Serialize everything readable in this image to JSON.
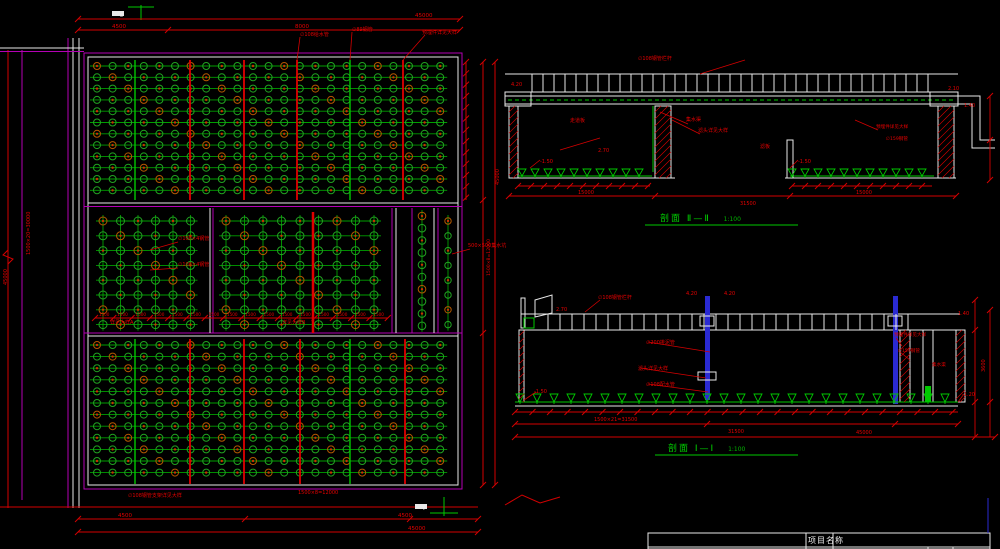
{
  "colors": {
    "background": "#000000",
    "cad_red": "#d40000",
    "cad_green": "#00c800",
    "nozzle_green": "#21a321",
    "nozzle_dot": "#c83200",
    "magenta": "#b400b4",
    "white": "#e9e9e9",
    "blue": "#2a2ad2"
  },
  "titles": {
    "section2": {
      "prefix": "剖面",
      "mark": "Ⅱ—Ⅱ",
      "scale": "1:100"
    },
    "section1": {
      "prefix": "剖面",
      "mark": "Ⅰ—Ⅰ",
      "scale": "1:100"
    },
    "title_block": {
      "project_label": "项目名称"
    },
    "marker_top": "Ⅱ",
    "marker_bottom": "Ⅰ"
  },
  "geometry": {
    "grids": [
      {
        "x": 97,
        "y": 66,
        "cols": 23,
        "rows": 12,
        "dx": 15.6,
        "dy": 11.3,
        "r": 3.5,
        "mesh": "h"
      },
      {
        "x": 97,
        "y": 345,
        "cols": 23,
        "rows": 12,
        "dx": 15.6,
        "dy": 11.6,
        "r": 3.5,
        "mesh": "h"
      },
      {
        "x": 103,
        "y": 221,
        "cols": 6,
        "rows": 8,
        "dx": 17.5,
        "dy": 14.8,
        "r": 4,
        "mesh": "hv"
      },
      {
        "x": 226,
        "y": 221,
        "cols": 9,
        "rows": 8,
        "dx": 18.5,
        "dy": 14.8,
        "r": 4,
        "mesh": "hv"
      },
      {
        "x": 422,
        "y": 216,
        "cols": 1,
        "rows": 10,
        "dx": 0,
        "dy": 12.2,
        "r": 3.8,
        "mesh": "v"
      },
      {
        "x": 448,
        "y": 221,
        "cols": 1,
        "rows": 8,
        "dx": 0,
        "dy": 14.8,
        "r": 3.2,
        "mesh": "v"
      }
    ],
    "feature_lines": [
      {
        "x": 135,
        "y1": 60,
        "y2": 200,
        "c": "#00c800",
        "w": 1.4
      },
      {
        "x": 190,
        "y1": 60,
        "y2": 200,
        "c": "#e00000",
        "w": 1.8
      },
      {
        "x": 244,
        "y1": 60,
        "y2": 200,
        "c": "#e00000",
        "w": 1.8
      },
      {
        "x": 297,
        "y1": 60,
        "y2": 200,
        "c": "#e00000",
        "w": 1.8
      },
      {
        "x": 350,
        "y1": 60,
        "y2": 200,
        "c": "#00c800",
        "w": 1.4
      },
      {
        "x": 403,
        "y1": 60,
        "y2": 200,
        "c": "#e00000",
        "w": 1.8
      },
      {
        "x": 135,
        "y1": 339,
        "y2": 484,
        "c": "#00c800",
        "w": 1.4
      },
      {
        "x": 190,
        "y1": 339,
        "y2": 484,
        "c": "#e00000",
        "w": 1.8
      },
      {
        "x": 244,
        "y1": 339,
        "y2": 484,
        "c": "#e00000",
        "w": 1.8
      },
      {
        "x": 300,
        "y1": 339,
        "y2": 484,
        "c": "#e00000",
        "w": 1.8
      },
      {
        "x": 350,
        "y1": 339,
        "y2": 484,
        "c": "#00c800",
        "w": 1.4
      },
      {
        "x": 405,
        "y1": 339,
        "y2": 484,
        "c": "#e00000",
        "w": 1.8
      },
      {
        "x": 313,
        "y1": 212,
        "y2": 333,
        "c": "#e00000",
        "w": 2.5
      }
    ],
    "ladders": [
      {
        "x1": 532,
        "x2": 935,
        "yt": 74,
        "yb": 92,
        "step": 11
      },
      {
        "x1": 548,
        "x2": 912,
        "yt": 314,
        "yb": 330,
        "step": 12
      }
    ],
    "triangle_rows": [
      {
        "x1": 522,
        "x2": 650,
        "y": 176,
        "step": 13,
        "h": 7
      },
      {
        "x1": 792,
        "x2": 932,
        "y": 176,
        "step": 13,
        "h": 7
      },
      {
        "x1": 520,
        "x2": 955,
        "y": 402,
        "step": 17,
        "h": 8
      }
    ],
    "tick_chains": [
      {
        "x1": 518,
        "x2": 650,
        "y": 186,
        "step": 13
      },
      {
        "x1": 792,
        "x2": 932,
        "y": 186,
        "step": 13
      },
      {
        "x1": 95,
        "x2": 388,
        "y": 318,
        "step": 18.3,
        "label": "1500"
      },
      {
        "x1": 515,
        "x2": 958,
        "y": 412,
        "step": 17.5
      },
      {
        "x1": 78,
        "x2": 460,
        "y": 19,
        "ticks": [
          78,
          460
        ]
      },
      {
        "x1": 78,
        "x2": 460,
        "y": 30,
        "ticks": [
          78,
          168,
          460
        ]
      },
      {
        "x1": 78,
        "x2": 478,
        "y": 519,
        "ticks": [
          78,
          245,
          410,
          478
        ]
      },
      {
        "x1": 78,
        "x2": 478,
        "y": 532,
        "ticks": [
          78,
          478
        ]
      },
      {
        "x1": 509,
        "x2": 956,
        "y": 196,
        "ticks": [
          509,
          655,
          790,
          956
        ]
      },
      {
        "x1": 515,
        "x2": 958,
        "y": 424,
        "ticks": [
          515,
          707,
          895,
          958
        ]
      },
      {
        "x1": 515,
        "x2": 995,
        "y": 437,
        "ticks": [
          515,
          995
        ]
      },
      {
        "x": 466,
        "y1": 62,
        "y2": 200,
        "step": 11.3,
        "vert": true
      },
      {
        "x": 483,
        "y1": 62,
        "y2": 485,
        "ticks": [
          62,
          200,
          333,
          485
        ],
        "vert": true
      },
      {
        "x": 495,
        "y1": 62,
        "y2": 485,
        "ticks": [
          62,
          485
        ],
        "vert": true
      },
      {
        "x": 990,
        "y1": 96,
        "y2": 180,
        "ticks": [
          96,
          140,
          180
        ],
        "vert": true
      },
      {
        "x": 975,
        "y1": 300,
        "y2": 437,
        "ticks": [
          300,
          330,
          402,
          437
        ],
        "vert": true
      },
      {
        "x": 990,
        "y1": 310,
        "y2": 437,
        "ticks": [
          310,
          402
        ],
        "vert": true
      }
    ],
    "hatches": [
      {
        "x": 509,
        "y": 106,
        "w": 9,
        "h": 72
      },
      {
        "x": 655,
        "y": 106,
        "w": 16,
        "h": 72
      },
      {
        "x": 938,
        "y": 106,
        "w": 16,
        "h": 72
      },
      {
        "x": 519,
        "y": 330,
        "w": 5,
        "h": 72
      },
      {
        "x": 900,
        "y": 330,
        "w": 10,
        "h": 72
      },
      {
        "x": 956,
        "y": 330,
        "w": 9,
        "h": 72
      }
    ],
    "leaders": [
      [
        560,
        150,
        600,
        138
      ],
      [
        688,
        124,
        660,
        112
      ],
      [
        700,
        134,
        672,
        120
      ],
      [
        745,
        60,
        700,
        74
      ],
      [
        540,
        160,
        530,
        168
      ],
      [
        798,
        160,
        790,
        168
      ],
      [
        878,
        130,
        855,
        120
      ],
      [
        600,
        300,
        585,
        312
      ],
      [
        648,
        342,
        710,
        352
      ],
      [
        640,
        368,
        706,
        378
      ],
      [
        648,
        384,
        708,
        392
      ],
      [
        896,
        338,
        902,
        346
      ],
      [
        900,
        352,
        910,
        360
      ],
      [
        536,
        392,
        524,
        400
      ],
      [
        964,
        394,
        958,
        402
      ],
      [
        470,
        249,
        452,
        254
      ],
      [
        178,
        242,
        150,
        250
      ],
      [
        178,
        268,
        150,
        270
      ],
      [
        300,
        37,
        297,
        60
      ],
      [
        352,
        32,
        350,
        60
      ],
      [
        425,
        35,
        403,
        60
      ]
    ]
  },
  "labels": [
    {
      "t": "45000",
      "x": 415,
      "y": 17
    },
    {
      "t": "4500",
      "x": 112,
      "y": 28
    },
    {
      "t": "8000",
      "x": 295,
      "y": 28
    },
    {
      "t": "∅108给水管",
      "x": 300,
      "y": 36,
      "s": 5
    },
    {
      "t": "∅89钢管",
      "x": 352,
      "y": 31,
      "s": 5
    },
    {
      "t": "预埋件详见大样",
      "x": 422,
      "y": 34,
      "s": 5
    },
    {
      "t": "1500×20=30000",
      "x": 30,
      "y": 255,
      "r": -90,
      "s": 5
    },
    {
      "t": "45000",
      "x": 7,
      "y": 285,
      "r": -90,
      "s": 5
    },
    {
      "t": "∅108×4钢管",
      "x": 178,
      "y": 240,
      "s": 5
    },
    {
      "t": "∅108×4钢管",
      "x": 178,
      "y": 266,
      "s": 5
    },
    {
      "t": "详见大样A",
      "x": 110,
      "y": 324,
      "s": 5
    },
    {
      "t": "详见大样B",
      "x": 282,
      "y": 324,
      "s": 5
    },
    {
      "t": "500×500集水坑",
      "x": 468,
      "y": 247,
      "s": 5
    },
    {
      "t": "1500×8=12000",
      "x": 490,
      "y": 276,
      "r": -90,
      "s": 4.6
    },
    {
      "t": "45000",
      "x": 499,
      "y": 185,
      "r": -90,
      "s": 5
    },
    {
      "t": "∅108钢管支架详见大样",
      "x": 128,
      "y": 497,
      "s": 5
    },
    {
      "t": "1500×8=12000",
      "x": 298,
      "y": 494,
      "s": 5
    },
    {
      "t": "4500",
      "x": 118,
      "y": 517
    },
    {
      "t": "4500",
      "x": 398,
      "y": 517
    },
    {
      "t": "45000",
      "x": 408,
      "y": 530
    },
    {
      "t": "∅108钢管栏杆",
      "x": 638,
      "y": 60,
      "s": 5
    },
    {
      "t": "2.70",
      "x": 598,
      "y": 152,
      "s": 5
    },
    {
      "t": "4.20",
      "x": 511,
      "y": 86,
      "s": 5
    },
    {
      "t": "走道板",
      "x": 570,
      "y": 122,
      "s": 5
    },
    {
      "t": "集水渠",
      "x": 686,
      "y": 121,
      "s": 5
    },
    {
      "t": "滤头详见大样",
      "x": 698,
      "y": 132,
      "s": 5
    },
    {
      "t": "滤板",
      "x": 760,
      "y": 148,
      "s": 5
    },
    {
      "t": "-1.50",
      "x": 540,
      "y": 163,
      "s": 5
    },
    {
      "t": "-1.50",
      "x": 798,
      "y": 163,
      "s": 5
    },
    {
      "t": "2.10",
      "x": 948,
      "y": 90,
      "s": 5
    },
    {
      "t": "1.40",
      "x": 964,
      "y": 107,
      "s": 5
    },
    {
      "t": "预埋件详见大样",
      "x": 876,
      "y": 128,
      "s": 4.6
    },
    {
      "t": "∅159钢管",
      "x": 886,
      "y": 140,
      "s": 4.6
    },
    {
      "t": "15000",
      "x": 578,
      "y": 194,
      "s": 5
    },
    {
      "t": "15000",
      "x": 856,
      "y": 194,
      "s": 5
    },
    {
      "t": "31500",
      "x": 740,
      "y": 205,
      "s": 5
    },
    {
      "t": "∅108钢管栏杆",
      "x": 598,
      "y": 299,
      "s": 5
    },
    {
      "t": "2.70",
      "x": 556,
      "y": 311,
      "s": 5
    },
    {
      "t": "4.20",
      "x": 686,
      "y": 295,
      "s": 5
    },
    {
      "t": "4.20",
      "x": 724,
      "y": 295,
      "s": 5
    },
    {
      "t": "1.40",
      "x": 958,
      "y": 315,
      "s": 5
    },
    {
      "t": "∅200排泥管",
      "x": 646,
      "y": 344,
      "s": 5
    },
    {
      "t": "滤头详见大样",
      "x": 638,
      "y": 370,
      "s": 5
    },
    {
      "t": "∅108配水管",
      "x": 646,
      "y": 386,
      "s": 5
    },
    {
      "t": "-1.50",
      "x": 534,
      "y": 393,
      "s": 5
    },
    {
      "t": "-1.20",
      "x": 962,
      "y": 396,
      "s": 5
    },
    {
      "t": "预埋件详见大样",
      "x": 894,
      "y": 336,
      "s": 4.6
    },
    {
      "t": "∅159钢管",
      "x": 898,
      "y": 352,
      "s": 4.6
    },
    {
      "t": "集水渠",
      "x": 932,
      "y": 366,
      "s": 4.6
    },
    {
      "t": "1500×21=31500",
      "x": 594,
      "y": 421,
      "s": 5
    },
    {
      "t": "31500",
      "x": 728,
      "y": 433,
      "s": 5
    },
    {
      "t": "45000",
      "x": 856,
      "y": 434,
      "s": 5
    },
    {
      "t": "3600",
      "x": 985,
      "y": 372,
      "r": -90,
      "s": 5
    },
    {
      "t": "Ⅱ",
      "x": 120,
      "y": 17,
      "c": "#f0f0f0",
      "s": 6
    },
    {
      "t": "Ⅰ",
      "x": 423,
      "y": 510,
      "c": "#f0f0f0",
      "s": 6
    }
  ]
}
